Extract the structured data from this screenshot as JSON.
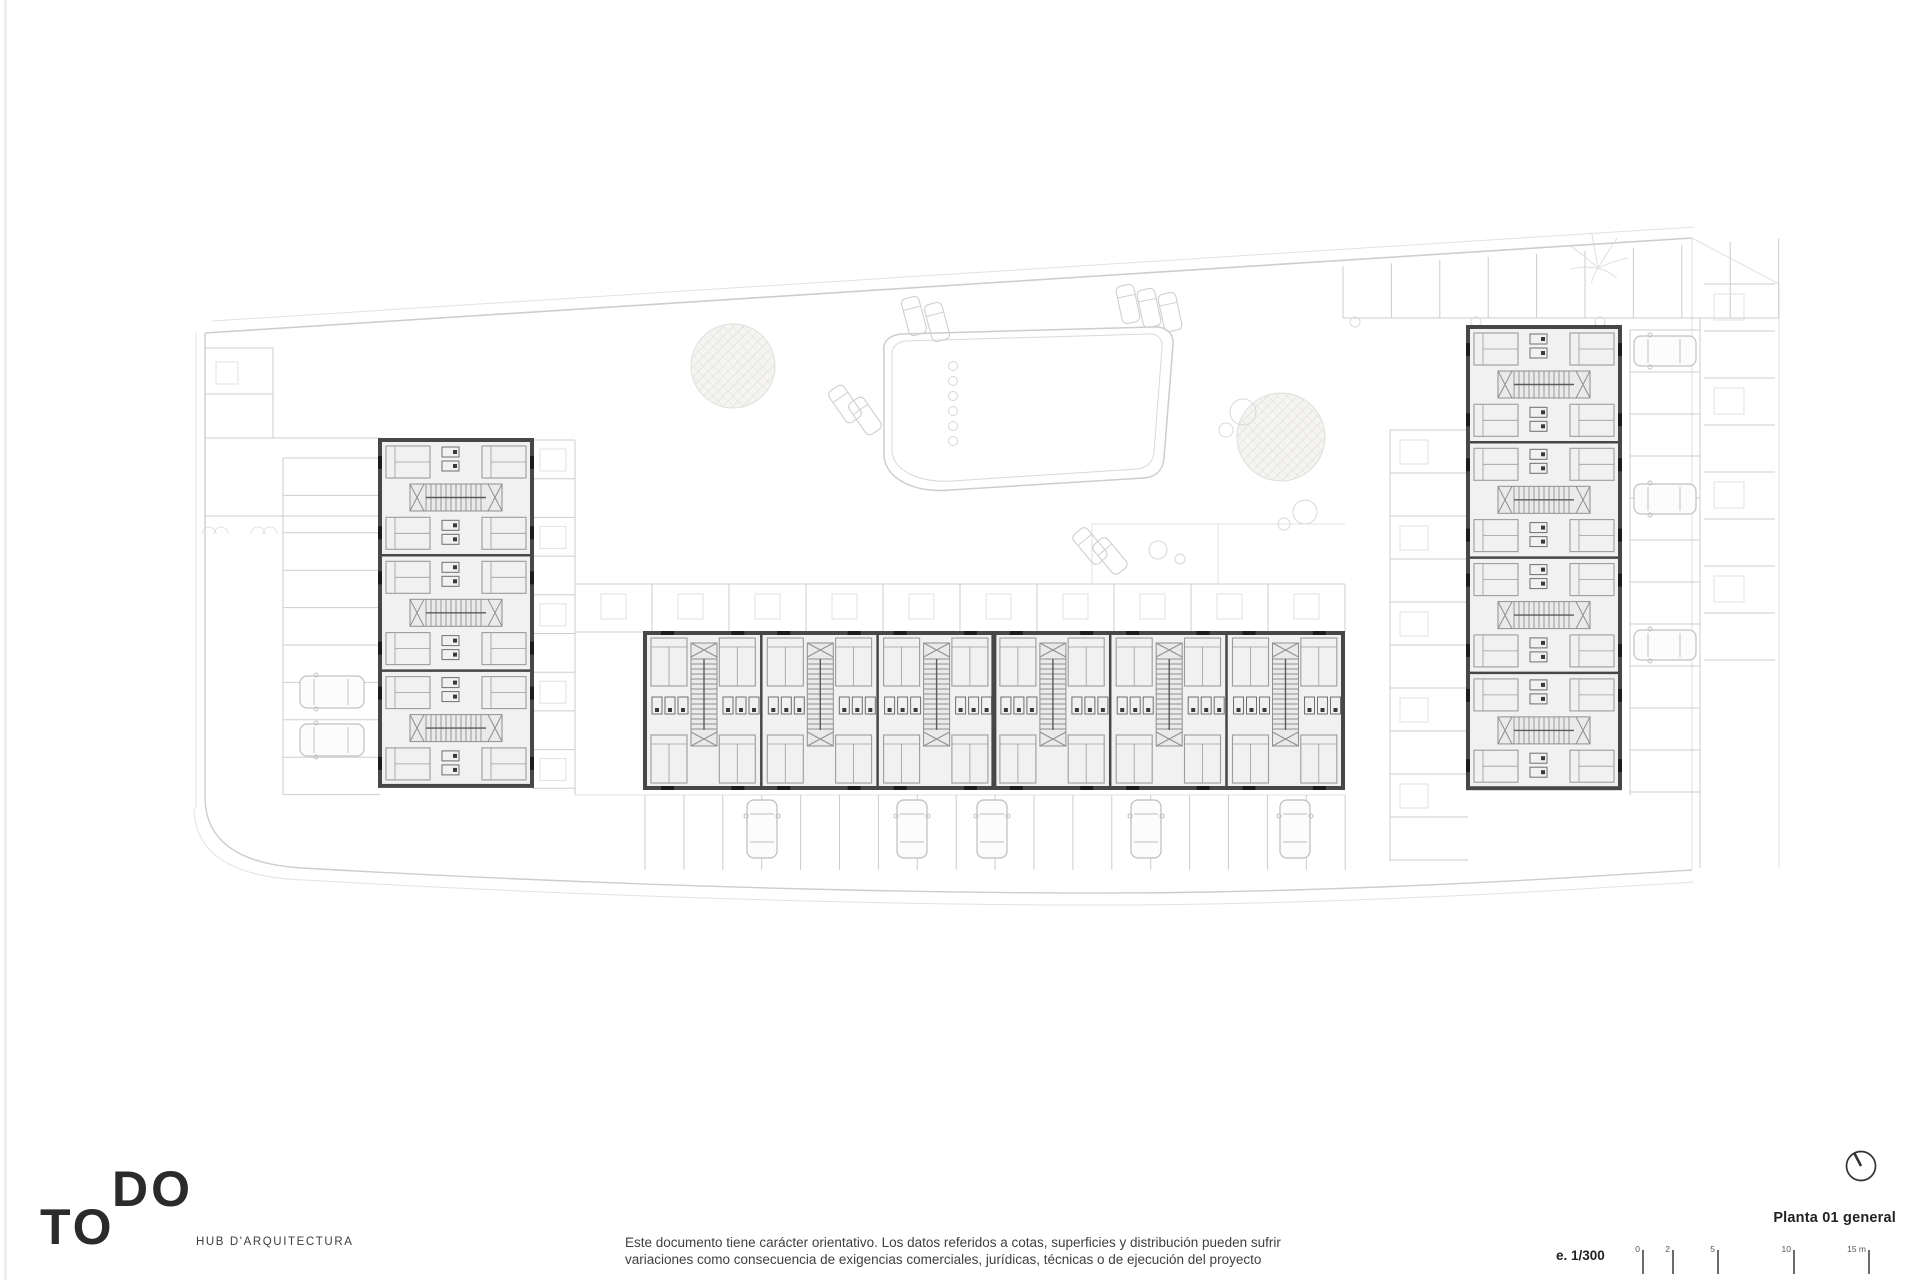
{
  "sheet": {
    "logo": {
      "word_top": "DO",
      "word_bottom": "TO",
      "tagline": "HUB D'ARQUITECTURA"
    },
    "disclaimer": {
      "line1": "Este documento tiene carácter orientativo. Los datos referidos a cotas, superficies y distribución pueden sufrir",
      "line2": "variaciones como consecuencia de exigencias comerciales, jurídicas, técnicas o de ejecución del proyecto"
    },
    "titleblock": {
      "title": "Planta 01 general",
      "scale_label": "e. 1/300",
      "scale_ticks": [
        "0",
        "2",
        "5",
        "10",
        "15 m"
      ]
    },
    "drawing": {
      "name": "Planta 01 general — site floor plan",
      "buildings": [
        "left residential block",
        "central residential block",
        "right residential block"
      ],
      "site_features": [
        "swimming pool",
        "sun loungers",
        "trees",
        "perimeter parking",
        "terraces"
      ]
    },
    "colors": {
      "plan_line": "#cfcfcf",
      "plan_wall": "#474747",
      "text": "#2b2b2b"
    }
  }
}
